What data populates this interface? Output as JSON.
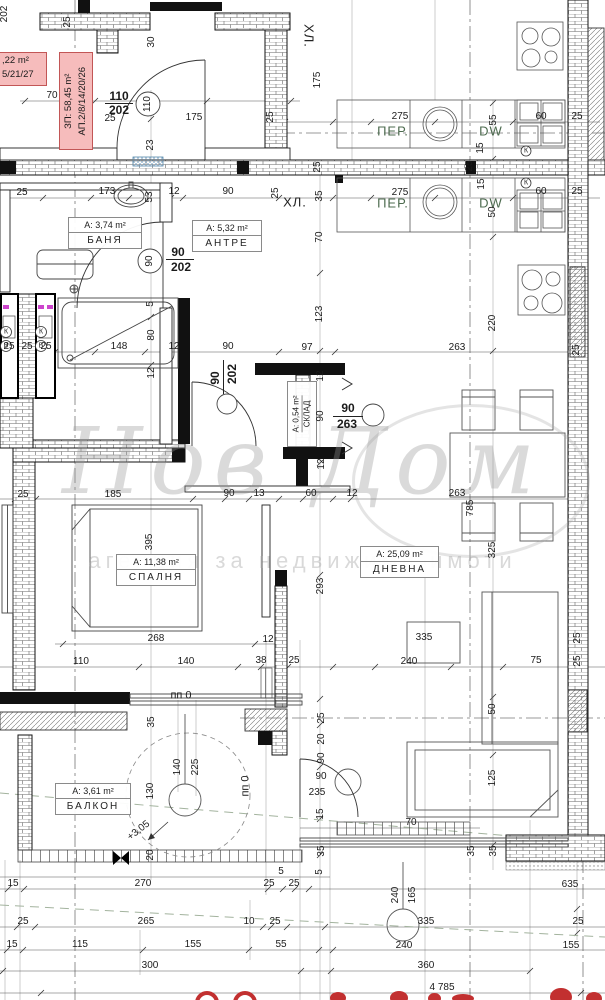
{
  "stamp": {
    "zp": "ЗП: 58,45 m²",
    "ap": "АП.2/8/14/20/26"
  },
  "stamp_partial": {
    "area": ",22 m²",
    "ap": "5/21/27"
  },
  "rooms": {
    "banya": {
      "area": "А: 3,74 m²",
      "name": "БАНЯ"
    },
    "antre": {
      "area": "А: 5,32 m²",
      "name": "АНТРЕ"
    },
    "spalnya": {
      "area": "А: 11,38 m²",
      "name": "СПАЛНЯ"
    },
    "dnevna": {
      "area": "А: 25,09 m²",
      "name": "ДНЕВНА"
    },
    "balkon": {
      "area": "А: 3,61 m²",
      "name": "БАЛКОН"
    },
    "sklad": {
      "area": "А: 0,54 m²",
      "name": "СКЛАД"
    }
  },
  "zones": {
    "hl_top": "ХЛ.",
    "hl_mid": "ХЛ.",
    "per_top": "ПЕР.",
    "per_mid": "ПЕР.",
    "dw_top": "DW",
    "dw_mid": "DW"
  },
  "doors": {
    "entry_w": "110",
    "entry_h": "202",
    "entry_circle": "110",
    "bath_w": "90",
    "bath_h": "202",
    "bath_circle": "90",
    "bedroom_w": "90",
    "bedroom_h": "202",
    "hall_w": "90",
    "hall_h": "263"
  },
  "risers": {
    "k": "К",
    "v": "В"
  },
  "marks": {
    "pp0_top": "пп 0",
    "pp0_right": "пп 0",
    "level": "+3,05"
  },
  "watermark": {
    "script": "Нов Дом",
    "line": "агенция за недвижими имоти"
  },
  "colors": {
    "stamp_bg": "#f6bcbc",
    "stamp_border": "#c25656",
    "green_label": "#4d6b4f",
    "red_fragment": "#c23030",
    "radiator_blue": "#6f9cc0"
  },
  "dims": [
    "202",
    "25",
    "30",
    "70",
    "25",
    "175",
    "23",
    "175",
    "275",
    "55",
    "60",
    "25",
    "15",
    "25",
    "25",
    "25",
    "25",
    "173",
    "53",
    "12",
    "90",
    "25",
    "35",
    "275",
    "15",
    "50",
    "60",
    "25",
    "70",
    "123",
    "220",
    "148",
    "80",
    "12",
    "5",
    "90",
    "97",
    "263",
    "25",
    "25",
    "25",
    "25",
    "12",
    "12",
    "90",
    "12",
    "90",
    "13",
    "60",
    "12",
    "25",
    "185",
    "395",
    "268",
    "12",
    "110",
    "140",
    "38",
    "25",
    "263",
    "785",
    "325",
    "293",
    "335",
    "240",
    "75",
    "25",
    "25",
    "35",
    "140",
    "225",
    "130",
    "20",
    "15",
    "270",
    "25",
    "25",
    "5",
    "25",
    "20",
    "90",
    "90",
    "235",
    "15",
    "50",
    "125",
    "70",
    "35",
    "35",
    "35",
    "5",
    "635",
    "25",
    "265",
    "10",
    "25",
    "15",
    "115",
    "155",
    "55",
    "300",
    "240",
    "165",
    "335",
    "240",
    "25",
    "155",
    "360",
    "4 785"
  ]
}
